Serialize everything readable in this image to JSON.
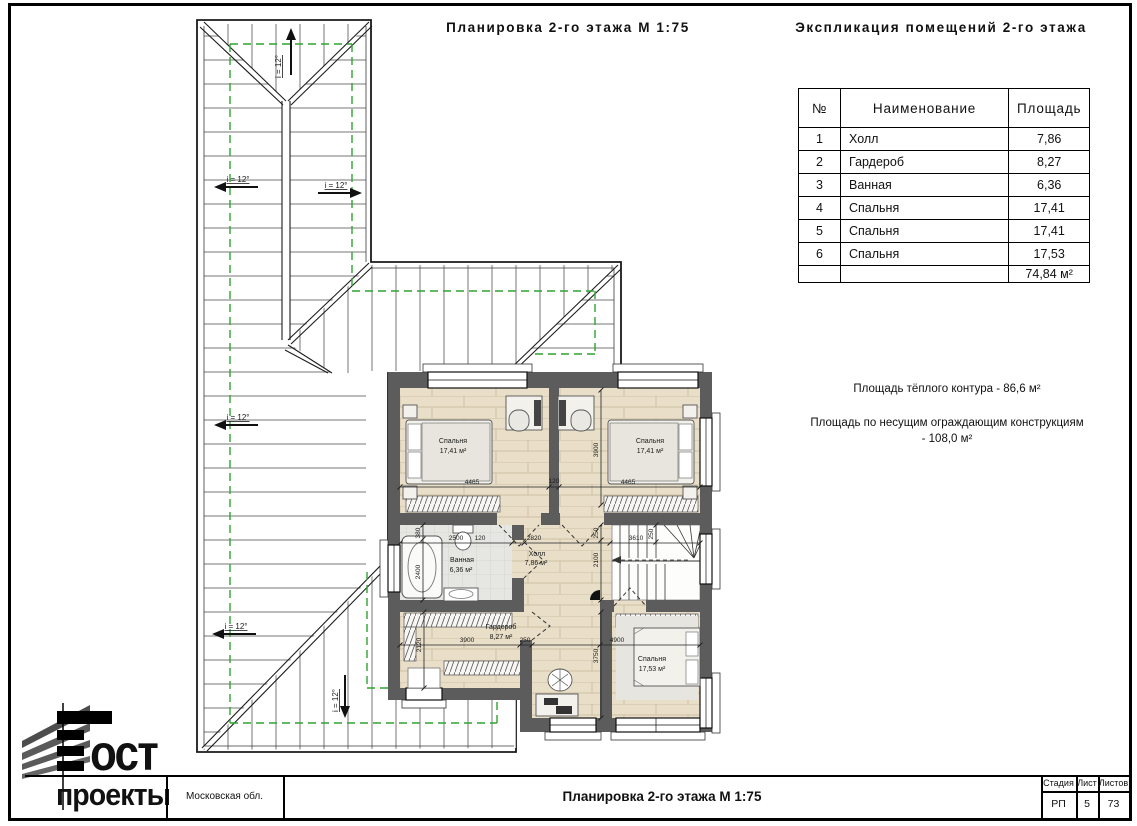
{
  "header": {
    "plan_title": "Планировка 2-го этажа  М 1:75",
    "table_title": "Экспликация помещений 2-го этажа"
  },
  "table": {
    "headers": [
      "№",
      "Наименование",
      "Площадь"
    ],
    "rows": [
      [
        "1",
        "Холл",
        "7,86"
      ],
      [
        "2",
        "Гардероб",
        "8,27"
      ],
      [
        "3",
        "Ванная",
        "6,36"
      ],
      [
        "4",
        "Спальня",
        "17,41"
      ],
      [
        "5",
        "Спальня",
        "17,41"
      ],
      [
        "6",
        "Спальня",
        "17,53"
      ]
    ],
    "total": "74,84 м²"
  },
  "notes": [
    "Площадь тёплого контура - 86,6 м²",
    "Площадь по несущим ограждающим конструкциям - 108,0 м²"
  ],
  "plan": {
    "slope_label": "i = 12°",
    "rooms": [
      {
        "name": "Спальня",
        "area": "17,41 м²"
      },
      {
        "name": "Спальня",
        "area": "17,41 м²"
      },
      {
        "name": "Ванная",
        "area": "6,36 м²"
      },
      {
        "name": "Холл",
        "area": "7,86 м²"
      },
      {
        "name": "Гардероб",
        "area": "8,27 м²"
      },
      {
        "name": "Спальня",
        "area": "17,53 м²"
      }
    ],
    "dims": {
      "w1": "4465",
      "w2": "120",
      "w3": "4465",
      "d1": "3900",
      "b1": "2500",
      "b2": "120",
      "h1": "2820",
      "s1": "3610",
      "b3": "380",
      "b4": "2400",
      "s2": "250",
      "s3": "2100",
      "s4": "250",
      "g1": "2120",
      "g2": "3900",
      "g3": "250",
      "r1": "4900",
      "r2": "3750"
    }
  },
  "titleblock": {
    "region": "Московская обл.",
    "doc_title": "Планировка 2-го этажа   М 1:75",
    "stage_label": "Стадия",
    "stage_value": "РП",
    "sheet_label": "Лист",
    "sheet_value": "5",
    "sheets_label": "Листов",
    "sheets_value": "73",
    "logo_top": "ост",
    "logo_bottom": "проекты"
  },
  "colors": {
    "wall": "#5c5c5c",
    "wood": "#e9dfc9",
    "green": "#2fa42f",
    "roof_hatch": "#8d8d8d"
  }
}
